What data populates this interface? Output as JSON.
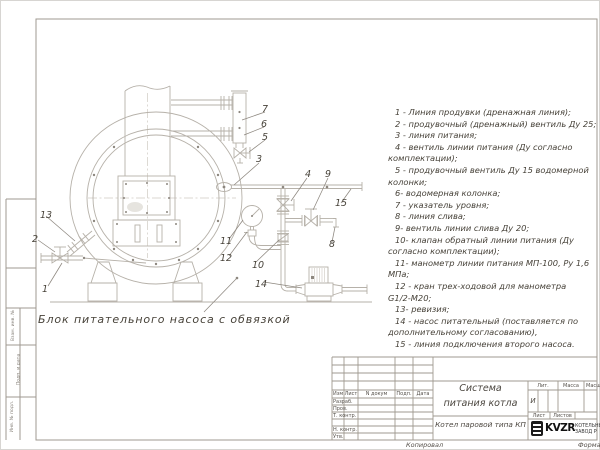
{
  "colors": {
    "line": "#b6b1a9",
    "frame": "#9f9990",
    "leader": "#8d877f",
    "text": "#4b463f"
  },
  "drawing": {
    "caption": "Блок питательного насоса с обвязкой",
    "callouts": [
      {
        "n": "1",
        "x": 42,
        "y": 284
      },
      {
        "n": "2",
        "x": 32,
        "y": 234
      },
      {
        "n": "13",
        "x": 40,
        "y": 210
      },
      {
        "n": "3",
        "x": 256,
        "y": 154
      },
      {
        "n": "4",
        "x": 305,
        "y": 169
      },
      {
        "n": "5",
        "x": 262,
        "y": 132
      },
      {
        "n": "6",
        "x": 261,
        "y": 119
      },
      {
        "n": "7",
        "x": 262,
        "y": 104
      },
      {
        "n": "8",
        "x": 329,
        "y": 239
      },
      {
        "n": "9",
        "x": 325,
        "y": 169
      },
      {
        "n": "10",
        "x": 252,
        "y": 260
      },
      {
        "n": "11",
        "x": 220,
        "y": 236
      },
      {
        "n": "12",
        "x": 220,
        "y": 253
      },
      {
        "n": "14",
        "x": 255,
        "y": 279
      },
      {
        "n": "15",
        "x": 335,
        "y": 198
      }
    ]
  },
  "legend": {
    "lines": [
      {
        "text": "1 - Линия продувки (дренажная линия);",
        "cont": false
      },
      {
        "text": "2 - продувочный (дренажный) вентиль Ду 25;",
        "cont": false
      },
      {
        "text": "3 - линия питания;",
        "cont": false
      },
      {
        "text": "4 - вентиль линии питания (Ду согласно",
        "cont": false
      },
      {
        "text": "комплектации);",
        "cont": true
      },
      {
        "text": "5 - продувочный вентиль Ду 15 водомерной",
        "cont": false
      },
      {
        "text": "колонки;",
        "cont": true
      },
      {
        "text": "6- водомерная колонка;",
        "cont": false
      },
      {
        "text": "7 - указатель уровня;",
        "cont": false
      },
      {
        "text": "8 - линия слива;",
        "cont": false
      },
      {
        "text": "9- вентиль линии слива Ду 20;",
        "cont": false
      },
      {
        "text": "10- клапан обратный линии питания (Ду",
        "cont": false
      },
      {
        "text": "согласно комплектации);",
        "cont": true
      },
      {
        "text": "11- манометр линии питания МП-100, Ру 1,6",
        "cont": false
      },
      {
        "text": "МПа;",
        "cont": true
      },
      {
        "text": "12 - кран трех-ходовой для манометра",
        "cont": false
      },
      {
        "text": "G1/2-М20;",
        "cont": true
      },
      {
        "text": "13- ревизия;",
        "cont": false
      },
      {
        "text": "14 - насос питательный (поставляется по",
        "cont": false
      },
      {
        "text": "дополнительному согласованию),",
        "cont": true
      },
      {
        "text": "15 - линия подключения второго насоса.",
        "cont": false
      }
    ]
  },
  "title_block": {
    "header_cols": {
      "izm": "Изм",
      "list": "Лист",
      "doc": "N докум",
      "podp": "Подп.",
      "data": "Дата"
    },
    "sign_rows": {
      "razrab": "Разраб.",
      "prov": "Пров.",
      "tkontr": "Т. контр.",
      "nkontr": "Н. контр.",
      "utv": "Утв."
    },
    "doc_title_line1": "Система",
    "doc_title_line2": "питания котла",
    "product": "Котел паровой типа КП",
    "lit_label": "Лит.",
    "lit_value": "И",
    "massa_label": "Масса",
    "masshtab_label": "Масштаб",
    "list_label": "Лист",
    "listov_label": "Листов",
    "logo": {
      "mark": "KVZR",
      "line1": "КОТЕЛЬНЫЙ",
      "line2": "ЗАВОД Р"
    },
    "footer": {
      "kopiroval": "Копировал",
      "format": "Формат"
    }
  },
  "margin_labels": {
    "a": "Взам. инв. №",
    "b": "Подп. и дата",
    "c": "Инв. № подл."
  }
}
